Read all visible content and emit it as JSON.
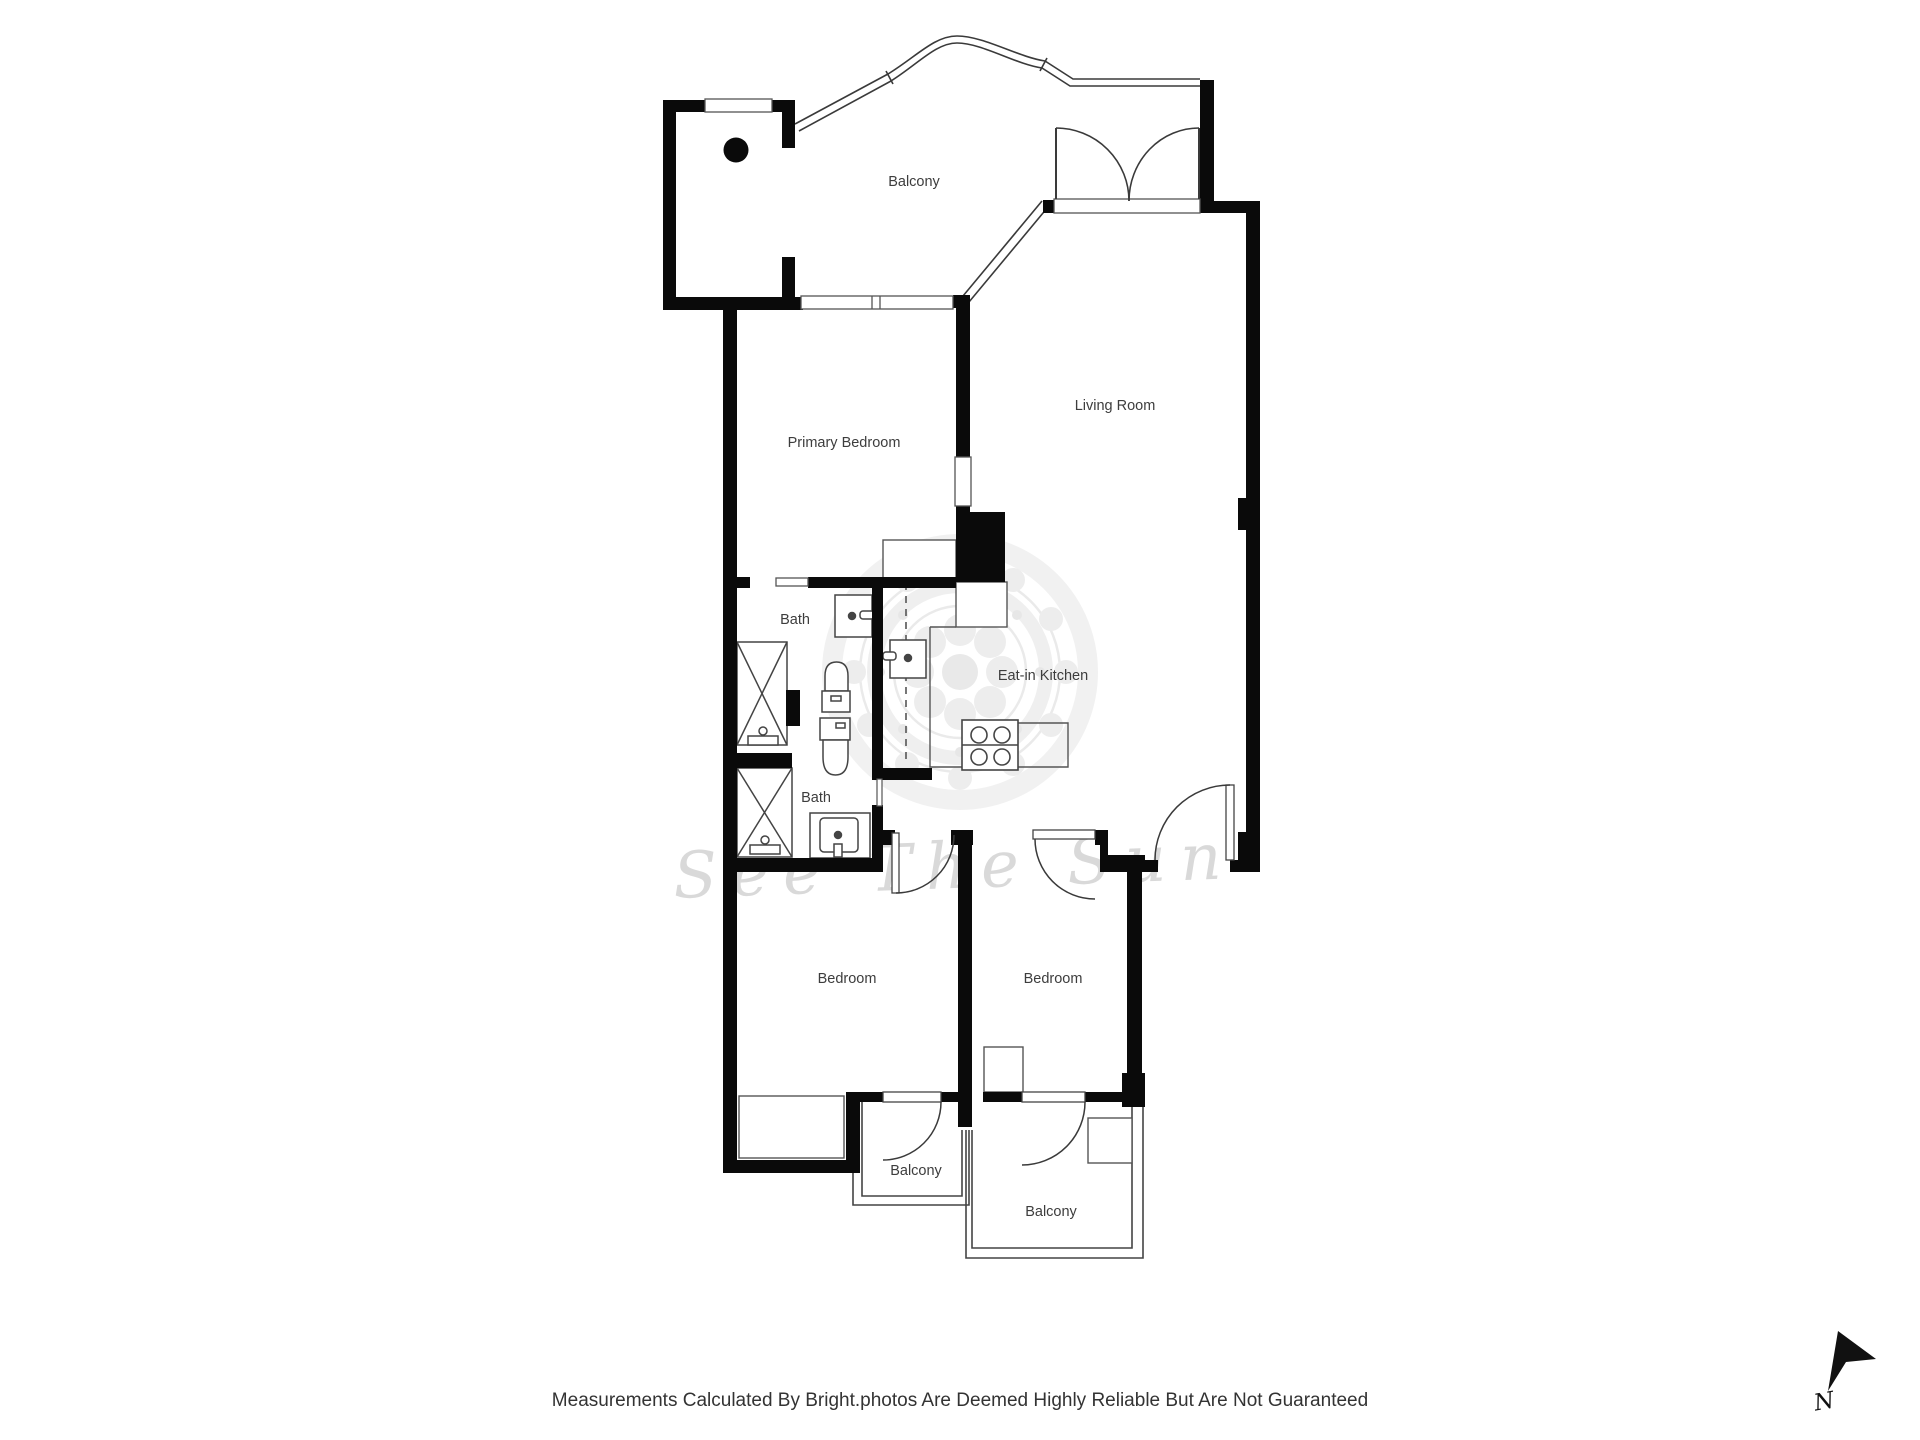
{
  "floor_plan": {
    "rooms": [
      {
        "id": "balcony-top",
        "label": "Balcony"
      },
      {
        "id": "primary-bedroom",
        "label": "Primary Bedroom"
      },
      {
        "id": "living-room",
        "label": "Living Room"
      },
      {
        "id": "bath-upper",
        "label": "Bath"
      },
      {
        "id": "eat-in-kitchen",
        "label": "Eat-in Kitchen"
      },
      {
        "id": "bath-lower",
        "label": "Bath"
      },
      {
        "id": "bedroom-left",
        "label": "Bedroom"
      },
      {
        "id": "bedroom-right",
        "label": "Bedroom"
      },
      {
        "id": "balcony-lower-left",
        "label": "Balcony"
      },
      {
        "id": "balcony-lower-right",
        "label": "Balcony"
      }
    ],
    "watermark": {
      "script_text": "See The Sun"
    },
    "compass": {
      "north_label": "N"
    }
  },
  "footer": {
    "disclaimer": "Measurements Calculated By Bright.photos Are Deemed Highly Reliable But Are Not Guaranteed"
  },
  "colors": {
    "wall": "#0a0a0a",
    "thin_line": "#3a3a3a",
    "label_text": "#3d3d3d",
    "watermark_gray": "#ececec",
    "script_gray": "#d9d9d9",
    "footer_text": "#333333",
    "background": "#ffffff"
  }
}
